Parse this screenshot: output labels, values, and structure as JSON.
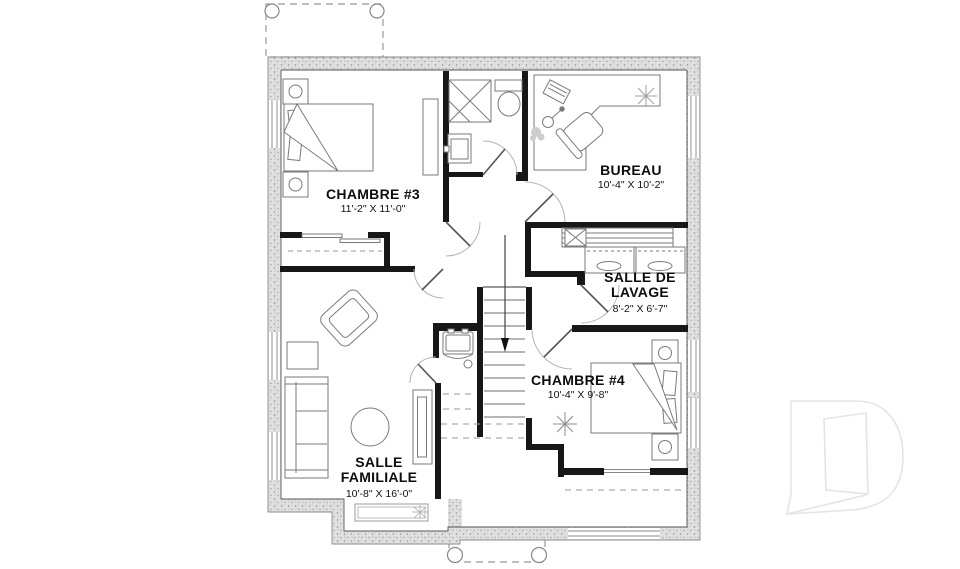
{
  "page": {
    "title": "Basement floor plan",
    "background_color": "#ffffff"
  },
  "floorplan": {
    "language": "French",
    "rooms": [
      {
        "id": "chambre-3",
        "label": "CHAMBRE #3",
        "dimensions": "11'-2\" X 11'-0\""
      },
      {
        "id": "bureau",
        "label": "BUREAU",
        "dimensions": "10'-4\" X 10'-2\""
      },
      {
        "id": "salle-de-lavage",
        "label": "SALLE DE LAVAGE",
        "dimensions": "8'-2\" X 6'-7\""
      },
      {
        "id": "chambre-4",
        "label": "CHAMBRE #4",
        "dimensions": "10'-4\" X 9'-8\""
      },
      {
        "id": "salle-familiale",
        "label": "SALLE FAMILIALE",
        "dimensions": "10'-8\" X 16'-0\""
      }
    ],
    "features": [
      "stairs-down-arrow",
      "bathroom-fixtures",
      "washer-dryer",
      "closet-rod",
      "deck-outline-top",
      "porch-outline-bottom",
      "window-well"
    ],
    "colors": {
      "interior_wall": "#171717",
      "exterior_wall_fill": "#e0e0e0",
      "furniture_line": "#7a7a7a",
      "watermark": "#e4e4e4"
    }
  }
}
